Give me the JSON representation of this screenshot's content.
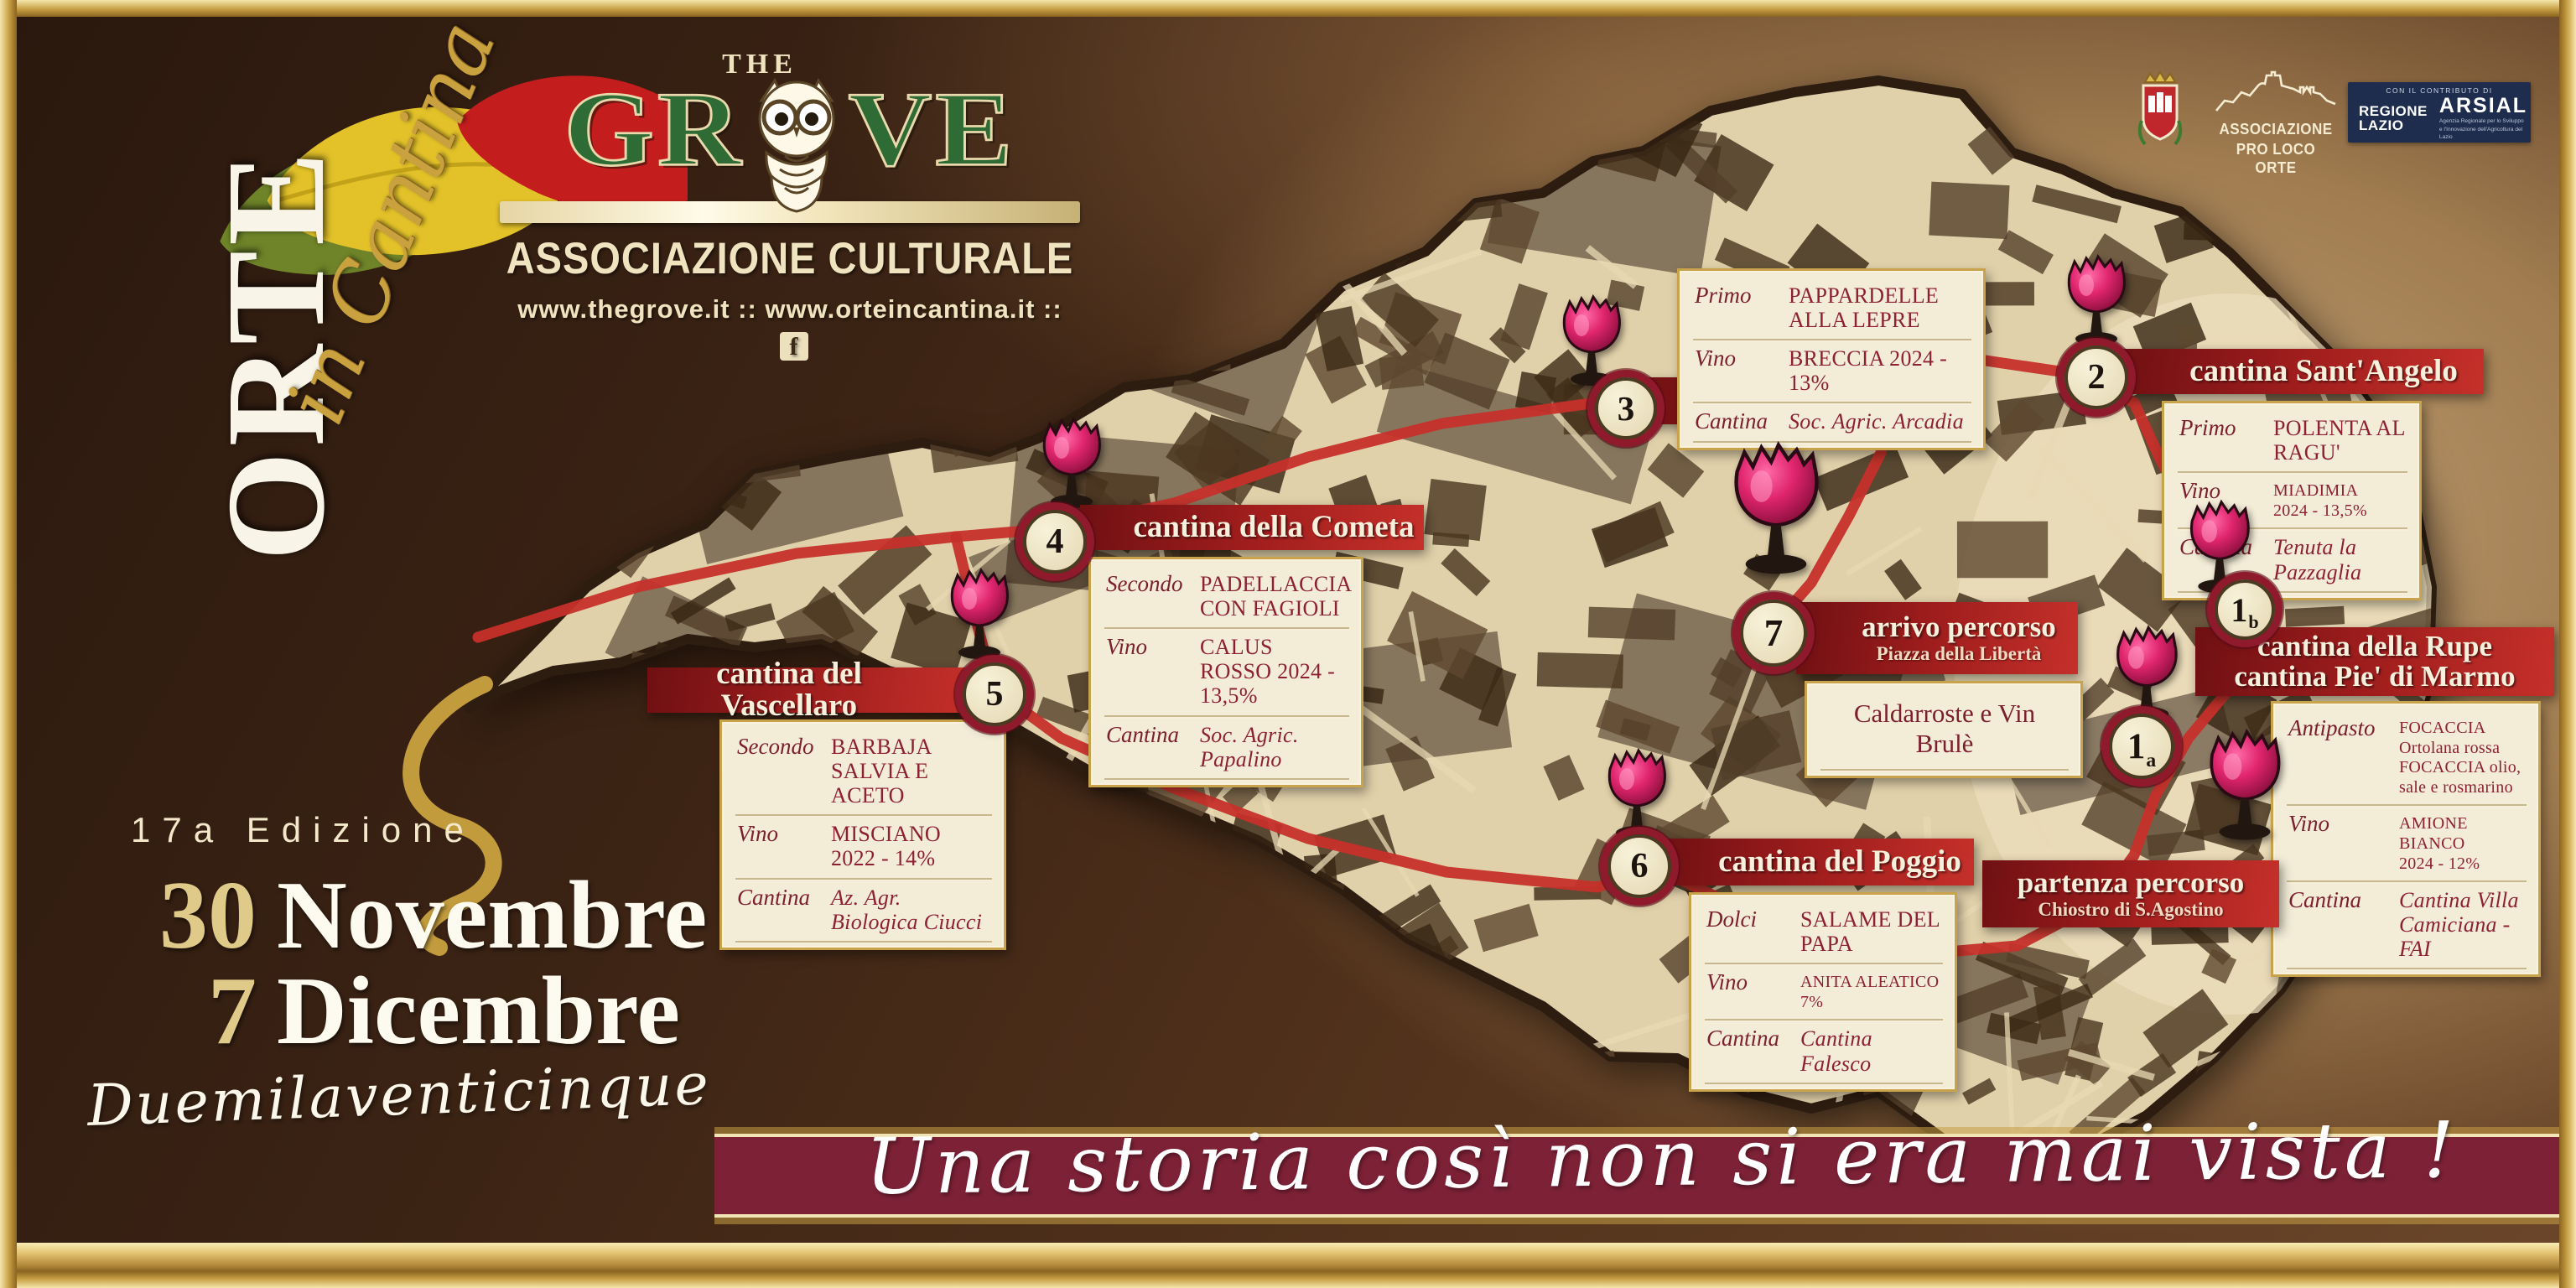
{
  "branding": {
    "orte_title": "ORTE",
    "orte_subtitle": "in Cantina",
    "grove_the": "THE",
    "grove_gr": "GR",
    "grove_ve": "VE",
    "grove_subtitle": "ASSOCIAZIONE CULTURALE",
    "grove_urls": "www.thegrove.it :: www.orteincantina.it ::",
    "facebook_f": "f"
  },
  "partners": {
    "pro_loco_line1": "ASSOCIAZIONE",
    "pro_loco_line2": "PRO LOCO ORTE",
    "contribution": "CON IL CONTRIBUTO DI",
    "regione_line1": "REGIONE",
    "regione_line2": "LAZIO",
    "arsial": "ARSIAL",
    "arsial_sub1": "Agenzia Regionale per lo Sviluppo",
    "arsial_sub2": "e l'Innovazione dell'Agricoltura del Lazio"
  },
  "edition": {
    "label": "17a Edizione",
    "date1_day": "30",
    "date1_month": "Novembre",
    "date2_day": "7",
    "date2_month": "Dicembre",
    "year": "Duemilaventicinque"
  },
  "tagline": "Una storia così non si era mai vista !",
  "colors": {
    "accent_red": "#c5302a",
    "maroon": "#7d2136",
    "gold": "#c9a23f",
    "cream": "#f3ecd7",
    "grove_green": "#2f6b35",
    "navy": "#1e2c4e",
    "wine": "#d6246b"
  },
  "stops": [
    {
      "id": "porcini",
      "badge": "3",
      "name": "cantina Porcini",
      "menu": [
        {
          "label": "Primo",
          "value": "PAPPARDELLE\nALLA LEPRE"
        },
        {
          "label": "Vino",
          "value": "BRECCIA 2024 - 13%"
        },
        {
          "label": "Cantina",
          "value": "Soc. Agric. Arcadia"
        }
      ]
    },
    {
      "id": "santangelo",
      "badge": "2",
      "name": "cantina Sant'Angelo",
      "menu": [
        {
          "label": "Primo",
          "value": "POLENTA AL RAGU'"
        },
        {
          "label": "Vino",
          "value": "MIADIMIA\n2024 - 13,5%"
        },
        {
          "label": "Cantina",
          "value": "Tenuta la Pazzaglia"
        }
      ]
    },
    {
      "id": "cometa",
      "badge": "4",
      "name": "cantina della Cometa",
      "menu": [
        {
          "label": "Secondo",
          "value": "PADELLACCIA\nCON FAGIOLI"
        },
        {
          "label": "Vino",
          "value": "CALUS ROSSO 2024 - 13,5%"
        },
        {
          "label": "Cantina",
          "value": "Soc. Agric. Papalino"
        }
      ]
    },
    {
      "id": "vascellaro",
      "badge": "5",
      "name": "cantina del Vascellaro",
      "menu": [
        {
          "label": "Secondo",
          "value": "BARBAJA\nSALVIA E ACETO"
        },
        {
          "label": "Vino",
          "value": "MISCIANO 2022 - 14%"
        },
        {
          "label": "Cantina",
          "value": "Az. Agr. Biologica Ciucci"
        }
      ]
    },
    {
      "id": "arrivo",
      "badge": "7",
      "name": "arrivo percorso",
      "subtitle": "Piazza della Libertà",
      "simple_card": "Caldarroste e Vin Brulè"
    },
    {
      "id": "rupe",
      "badge": "1",
      "badge_suffix": "b",
      "name": "cantina della Rupe\ncantina Pie' di Marmo",
      "menu": [
        {
          "label": "Antipasto",
          "value": "FOCACCIA Ortolana rossa\nFOCACCIA  olio, sale e rosmarino"
        },
        {
          "label": "Vino",
          "value": "AMIONE BIANCO\n2024 - 12%"
        },
        {
          "label": "Cantina",
          "value": "Cantina Villa Camiciana - FAI"
        }
      ]
    },
    {
      "id": "poggio",
      "badge": "6",
      "name": "cantina del Poggio",
      "menu": [
        {
          "label": "Dolci",
          "value": "SALAME DEL PAPA"
        },
        {
          "label": "Vino",
          "value": "ANITA ALEATICO\n7%"
        },
        {
          "label": "Cantina",
          "value": "Cantina Falesco"
        }
      ]
    },
    {
      "id": "partenza",
      "name": "partenza percorso",
      "subtitle": "Chiostro di S.Agostino"
    },
    {
      "id": "start_a",
      "badge": "1",
      "badge_suffix": "a"
    }
  ]
}
